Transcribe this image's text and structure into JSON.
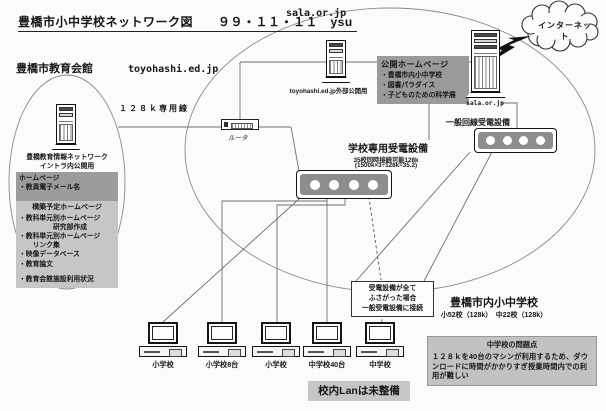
{
  "page": {
    "title": "豊橋市小中学校ネットワーク図　　９９・１１・１１　ysu"
  },
  "domains": {
    "sala_top": "sala.or.jp",
    "toyohashi": "toyohashi.ed.jp"
  },
  "internet": {
    "label": "インターネット"
  },
  "leased_line_label": "１２８ｋ専用線",
  "router_label": "ルータ",
  "education_hall": {
    "title": "豊橋市教育会館",
    "server_name": "豊橋教育情報ネットワーク",
    "server_note": "イントラ内公開用",
    "homepage_header": "ホームページ",
    "homepage_item": "・教員電子メール名",
    "planned_header": "構築予定ホームページ",
    "planned_items": [
      "・教科単元別ホームページ",
      "　　　　　研究部作成",
      "・教科単元別ホームページ",
      "　　リンク集",
      "・映像データベース",
      "・教育論文",
      "・教育会館施設利用状況"
    ]
  },
  "public_homepage": {
    "title": "公開ホームページ",
    "items": [
      "・豊橋市内小中学校",
      "・図書パラダイス",
      "・子どものための科学展"
    ]
  },
  "servers": {
    "toyohashi_external": "toyohashi.ed.jp外部公開用",
    "sala": "sala.or.jp"
  },
  "school_modem": {
    "title": "学校専用受電設備",
    "capacity": "35校同時接続可能128k",
    "formula": "(1500k×3÷128k=35.2)"
  },
  "general_modem": {
    "title": "一般回線受電設備"
  },
  "fallback_note": {
    "lines": [
      "受電設備が全て",
      "ふさがった場合",
      "一般受電設備に接続"
    ]
  },
  "schools": {
    "title": "豊橋市内小中学校",
    "counts": "小52校（128k）　中22校（128k）",
    "problem_title": "中学校の問題点",
    "problem_text": "１２８ｋを40台のマシンが利用するため、ダウンロードに時間がかかりすぎ授業時間内での利用が難しい",
    "computers": [
      {
        "label": "小学校"
      },
      {
        "label": "小学校8台"
      },
      {
        "label": "小学校"
      },
      {
        "label": "中学校40台"
      },
      {
        "label": "中学校"
      }
    ],
    "lan_note": "校内Lanは未整備"
  },
  "colors": {
    "box_gray": "#9a9a9a",
    "light_gray": "#c6c6c6",
    "bank_gray": "#8d8d8d"
  }
}
